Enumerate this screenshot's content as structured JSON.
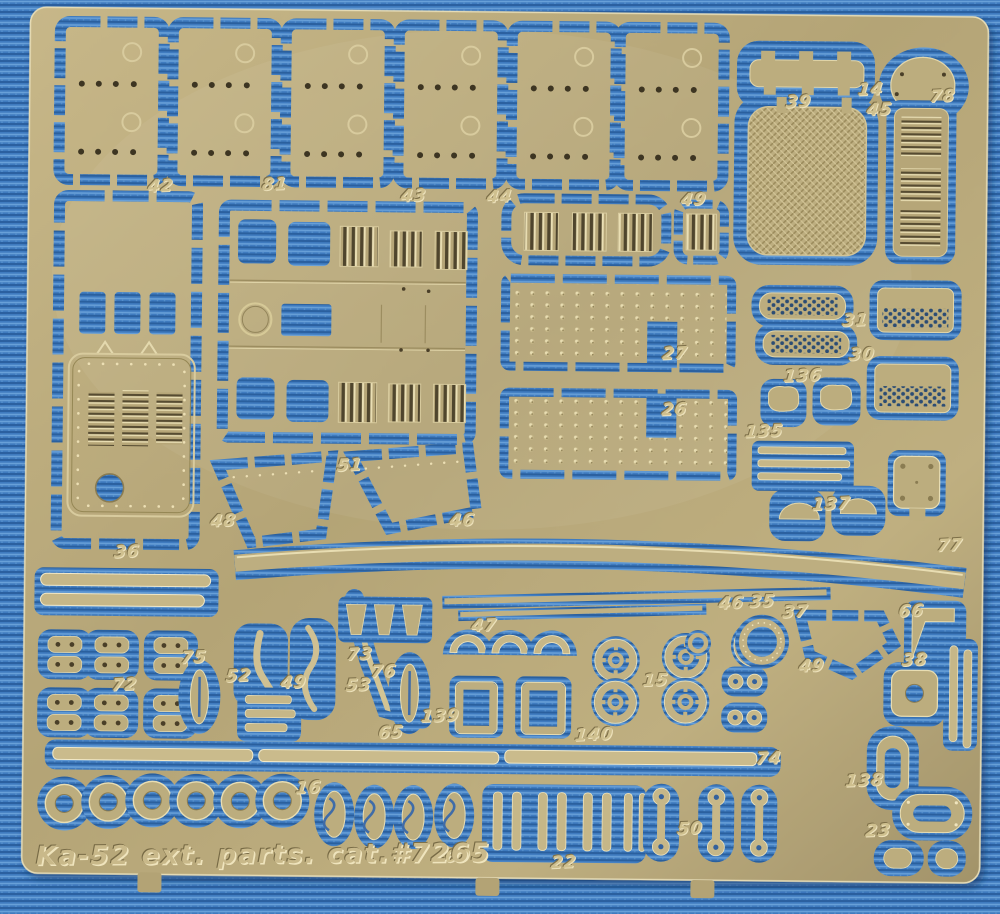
{
  "scene": {
    "type": "photograph",
    "subject": "photo-etched brass model detail fret on blue fabric",
    "caption": "Ka-52 ext. parts. cat.#7265"
  },
  "colors": {
    "fabric_blue": "#3f7bbf",
    "fabric_weave_dark": "#2a5f9e",
    "fabric_weave_light": "#68a0d8",
    "brass_base": "#b6a678",
    "brass_light": "#cbbc8d",
    "brass_shadow": "#877a55",
    "etch_highlight": "#eadfb4",
    "slot_dark": "#4f452d"
  },
  "part_labels": [
    {
      "n": "42",
      "x": 158,
      "y": 190
    },
    {
      "n": "81",
      "x": 272,
      "y": 187
    },
    {
      "n": "43",
      "x": 411,
      "y": 197
    },
    {
      "n": "44",
      "x": 497,
      "y": 197
    },
    {
      "n": "49",
      "x": 691,
      "y": 198
    },
    {
      "n": "39",
      "x": 795,
      "y": 99
    },
    {
      "n": "14",
      "x": 867,
      "y": 86
    },
    {
      "n": "45",
      "x": 876,
      "y": 106
    },
    {
      "n": "78",
      "x": 939,
      "y": 92
    },
    {
      "n": "31",
      "x": 854,
      "y": 317
    },
    {
      "n": "30",
      "x": 861,
      "y": 351
    },
    {
      "n": "27",
      "x": 674,
      "y": 352
    },
    {
      "n": "26",
      "x": 674,
      "y": 408
    },
    {
      "n": "136",
      "x": 802,
      "y": 373
    },
    {
      "n": "135",
      "x": 764,
      "y": 429
    },
    {
      "n": "137",
      "x": 832,
      "y": 501
    },
    {
      "n": "77",
      "x": 951,
      "y": 541
    },
    {
      "n": "51",
      "x": 350,
      "y": 467
    },
    {
      "n": "48",
      "x": 224,
      "y": 524
    },
    {
      "n": "46",
      "x": 463,
      "y": 521
    },
    {
      "n": "36",
      "x": 128,
      "y": 556
    },
    {
      "n": "46",
      "x": 733,
      "y": 601
    },
    {
      "n": "35",
      "x": 764,
      "y": 599
    },
    {
      "n": "37",
      "x": 797,
      "y": 609
    },
    {
      "n": "66",
      "x": 913,
      "y": 607
    },
    {
      "n": "49",
      "x": 814,
      "y": 663
    },
    {
      "n": "38",
      "x": 917,
      "y": 656
    },
    {
      "n": "75",
      "x": 196,
      "y": 661
    },
    {
      "n": "72",
      "x": 127,
      "y": 689
    },
    {
      "n": "52",
      "x": 241,
      "y": 679
    },
    {
      "n": "49",
      "x": 296,
      "y": 685
    },
    {
      "n": "73",
      "x": 362,
      "y": 656
    },
    {
      "n": "53",
      "x": 361,
      "y": 687
    },
    {
      "n": "76",
      "x": 386,
      "y": 673
    },
    {
      "n": "139",
      "x": 443,
      "y": 717
    },
    {
      "n": "65",
      "x": 394,
      "y": 734
    },
    {
      "n": "47",
      "x": 486,
      "y": 626
    },
    {
      "n": "15",
      "x": 658,
      "y": 679
    },
    {
      "n": "140",
      "x": 597,
      "y": 734
    },
    {
      "n": "74",
      "x": 772,
      "y": 756
    },
    {
      "n": "138",
      "x": 868,
      "y": 777
    },
    {
      "n": "16",
      "x": 312,
      "y": 790
    },
    {
      "n": "60",
      "x": 462,
      "y": 857
    },
    {
      "n": "22",
      "x": 568,
      "y": 862
    },
    {
      "n": "50",
      "x": 694,
      "y": 827
    },
    {
      "n": "23",
      "x": 882,
      "y": 827
    }
  ]
}
